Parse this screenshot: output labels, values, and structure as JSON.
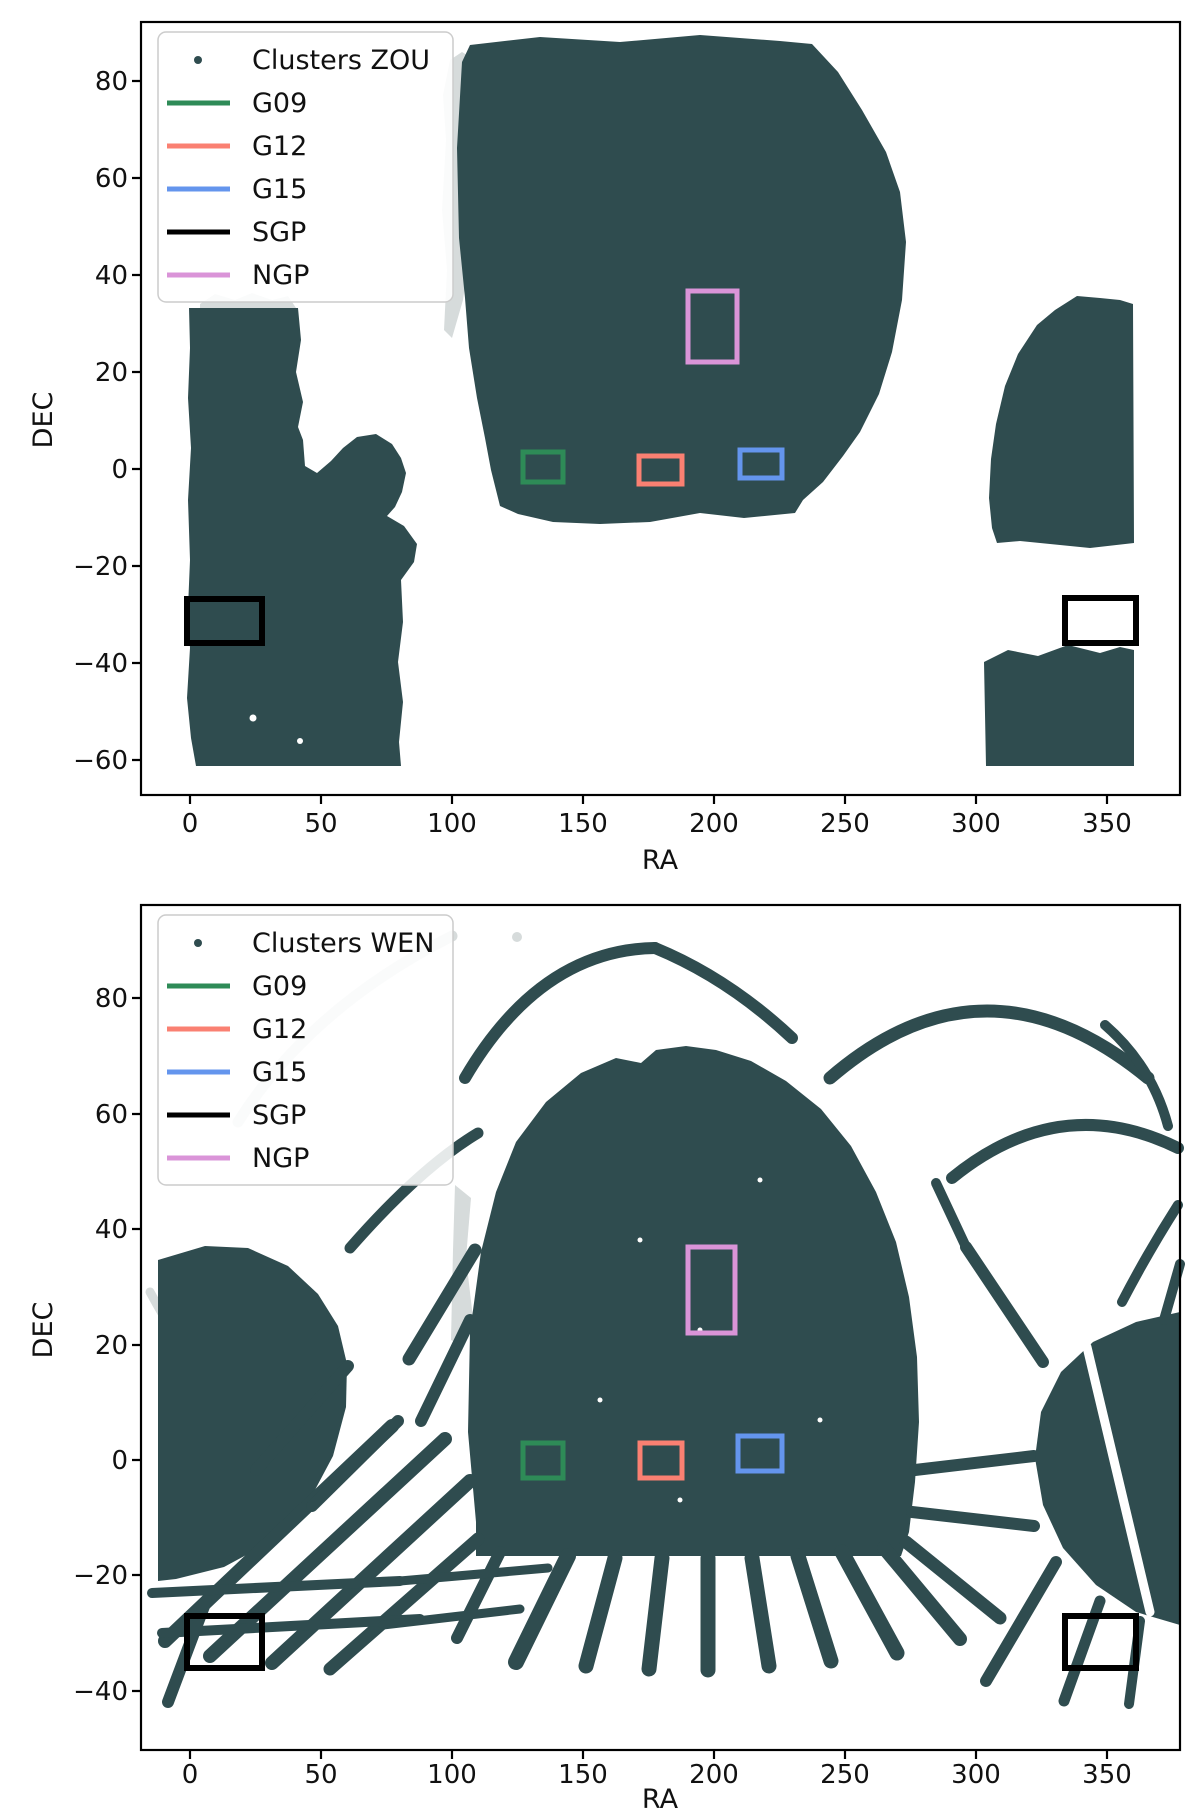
{
  "page": {
    "background": "#ffffff",
    "figure_count": 2
  },
  "colors": {
    "clusters": "#2F4C4F",
    "masked_gray": "#D6DBDB",
    "g09": "#2E8B57",
    "g12": "#FA8072",
    "g15": "#6495ED",
    "sgp": "#000000",
    "ngp": "#DA94D8",
    "axis": "#000000",
    "legend_border": "#CCCCCC"
  },
  "chart_data": [
    {
      "type": "scatter",
      "title": "",
      "xlabel": "RA",
      "ylabel": "DEC",
      "xlim": [
        -18,
        378
      ],
      "ylim": [
        -67,
        92
      ],
      "grid": false,
      "legend_position": "upper left",
      "x_ticks": [
        "0",
        "50",
        "100",
        "150",
        "200",
        "250",
        "300",
        "350"
      ],
      "x_tick_values": [
        0,
        50,
        100,
        150,
        200,
        250,
        300,
        350
      ],
      "y_ticks": [
        "80",
        "60",
        "40",
        "20",
        "0",
        "−20",
        "−40",
        "−60"
      ],
      "y_tick_values": [
        80,
        60,
        40,
        20,
        0,
        -20,
        -40,
        -60
      ],
      "legend": [
        {
          "label": "Clusters ZOU",
          "swatch": "dot-marker",
          "color": "#2F4C4F"
        },
        {
          "label": "G09",
          "swatch": "line",
          "color": "#2E8B57"
        },
        {
          "label": "G12",
          "swatch": "line",
          "color": "#FA8072"
        },
        {
          "label": "G15",
          "swatch": "line",
          "color": "#6495ED"
        },
        {
          "label": "SGP",
          "swatch": "line",
          "color": "#000000"
        },
        {
          "label": "NGP",
          "swatch": "line",
          "color": "#DA94D8"
        }
      ],
      "series_name": "Clusters ZOU",
      "footprint_regions": [
        {
          "name": "north-galactic-main",
          "ra": [
            100,
            290
          ],
          "dec": [
            -10,
            87
          ]
        },
        {
          "name": "south-left-block",
          "ra": [
            0,
            88
          ],
          "dec": [
            -61,
            45
          ]
        },
        {
          "name": "south-right-upper",
          "ra": [
            305,
            360
          ],
          "dec": [
            -16,
            34
          ]
        },
        {
          "name": "south-right-lower",
          "ra": [
            303,
            360
          ],
          "dec": [
            -61,
            -38
          ]
        },
        {
          "name": "masked-gray-sliver",
          "ra": [
            96,
            106
          ],
          "dec": [
            45,
            85
          ]
        }
      ],
      "field_boxes": [
        {
          "name": "G09",
          "ra": [
            127,
            142
          ],
          "dec": [
            -2.7,
            3.5
          ]
        },
        {
          "name": "G12",
          "ra": [
            171,
            188
          ],
          "dec": [
            -3.1,
            2.7
          ]
        },
        {
          "name": "G15",
          "ra": [
            209,
            226
          ],
          "dec": [
            -1.9,
            3.9
          ]
        },
        {
          "name": "SGP-left",
          "ra": [
            0,
            27
          ],
          "dec": [
            -36,
            -27
          ]
        },
        {
          "name": "SGP-right",
          "ra": [
            334,
            361
          ],
          "dec": [
            -36,
            -27
          ]
        },
        {
          "name": "NGP",
          "ra": [
            190,
            209
          ],
          "dec": [
            22,
            37
          ]
        }
      ]
    },
    {
      "type": "scatter",
      "title": "",
      "xlabel": "RA",
      "ylabel": "DEC",
      "xlim": [
        -18,
        378
      ],
      "ylim": [
        -50,
        96
      ],
      "grid": false,
      "legend_position": "upper left",
      "x_ticks": [
        "0",
        "50",
        "100",
        "150",
        "200",
        "250",
        "300",
        "350"
      ],
      "x_tick_values": [
        0,
        50,
        100,
        150,
        200,
        250,
        300,
        350
      ],
      "y_ticks": [
        "80",
        "60",
        "40",
        "20",
        "0",
        "−20",
        "−40"
      ],
      "y_tick_values": [
        80,
        60,
        40,
        20,
        0,
        -20,
        -40
      ],
      "legend": [
        {
          "label": "Clusters WEN",
          "swatch": "dot-marker",
          "color": "#2F4C4F"
        },
        {
          "label": "G09",
          "swatch": "line",
          "color": "#2E8B57"
        },
        {
          "label": "G12",
          "swatch": "line",
          "color": "#FA8072"
        },
        {
          "label": "G15",
          "swatch": "line",
          "color": "#6495ED"
        },
        {
          "label": "SGP",
          "swatch": "line",
          "color": "#000000"
        },
        {
          "label": "NGP",
          "swatch": "line",
          "color": "#DA94D8"
        }
      ],
      "series_name": "Clusters WEN",
      "footprint_regions": [
        {
          "name": "central-dome",
          "ra": [
            107,
            278
          ],
          "dec": [
            -17,
            70
          ]
        },
        {
          "name": "central-fan-streaks",
          "ra": [
            100,
            310
          ],
          "dec": [
            -35,
            -17
          ]
        },
        {
          "name": "left-fan-block",
          "ra": [
            -10,
            75
          ],
          "dec": [
            -38,
            38
          ]
        },
        {
          "name": "right-block",
          "ra": [
            325,
            378
          ],
          "dec": [
            -37,
            28
          ]
        },
        {
          "name": "top-arcs",
          "ra": [
            110,
            370
          ],
          "dec": [
            55,
            85
          ]
        },
        {
          "name": "masked-gray-arcs",
          "ra": [
            15,
            115
          ],
          "dec": [
            25,
            80
          ]
        }
      ],
      "field_boxes": [
        {
          "name": "G09",
          "ra": [
            127,
            142
          ],
          "dec": [
            -3.1,
            2.9
          ]
        },
        {
          "name": "G12",
          "ra": [
            171,
            188
          ],
          "dec": [
            -3.1,
            2.9
          ]
        },
        {
          "name": "G15",
          "ra": [
            209,
            226
          ],
          "dec": [
            -1.9,
            4.2
          ]
        },
        {
          "name": "SGP-left",
          "ra": [
            0,
            27
          ],
          "dec": [
            -36,
            -27
          ]
        },
        {
          "name": "SGP-right",
          "ra": [
            334,
            361
          ],
          "dec": [
            -36,
            -27
          ]
        },
        {
          "name": "NGP",
          "ra": [
            190,
            209
          ],
          "dec": [
            22,
            37
          ]
        }
      ]
    }
  ]
}
